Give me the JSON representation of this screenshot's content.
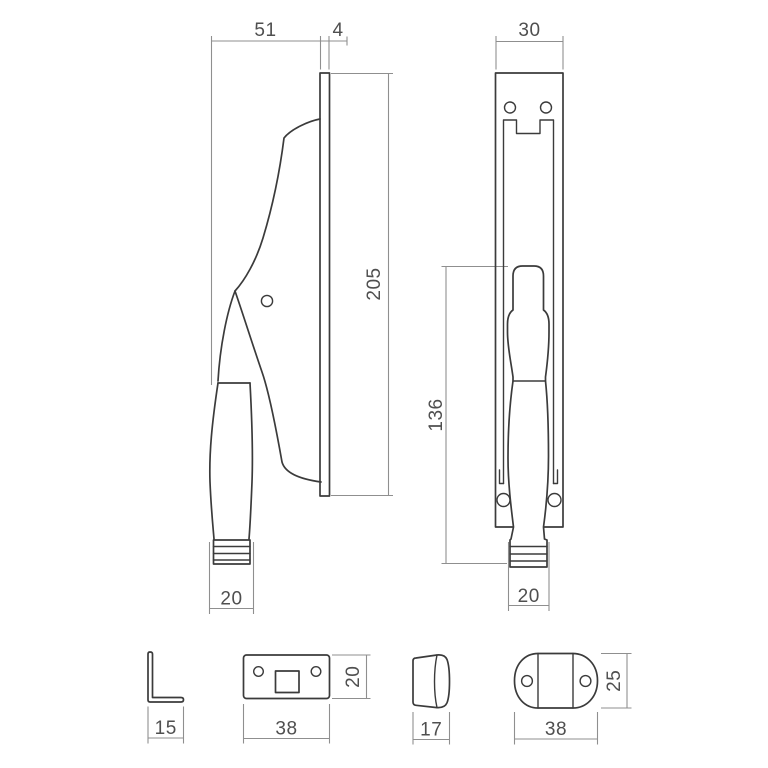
{
  "drawing": {
    "type": "technical-dimension-drawing",
    "units_implied": "mm",
    "views": {
      "side_view": {
        "name": "handle-side-view",
        "labels": {
          "projection": "51",
          "plate_thickness": "4",
          "height": "205",
          "grip_diameter": "20"
        }
      },
      "front_view": {
        "name": "handle-front-view",
        "labels": {
          "plate_width": "30",
          "handle_length": "136",
          "grip_diameter": "20"
        }
      },
      "angle_bracket": {
        "name": "angle-bracket",
        "labels": {
          "leg_length": "15"
        }
      },
      "strike_plate": {
        "name": "strike-plate",
        "labels": {
          "width": "38",
          "height": "20"
        }
      },
      "end_cap": {
        "name": "end-cap-side-view",
        "labels": {
          "depth": "17"
        }
      },
      "oval_plate": {
        "name": "oval-keep-plate",
        "labels": {
          "width": "38",
          "height": "25"
        }
      }
    },
    "colors": {
      "outline": "#3b3b3b",
      "dimension": "#8f8f8f",
      "text": "#4f4f4f",
      "background": "#ffffff"
    }
  }
}
